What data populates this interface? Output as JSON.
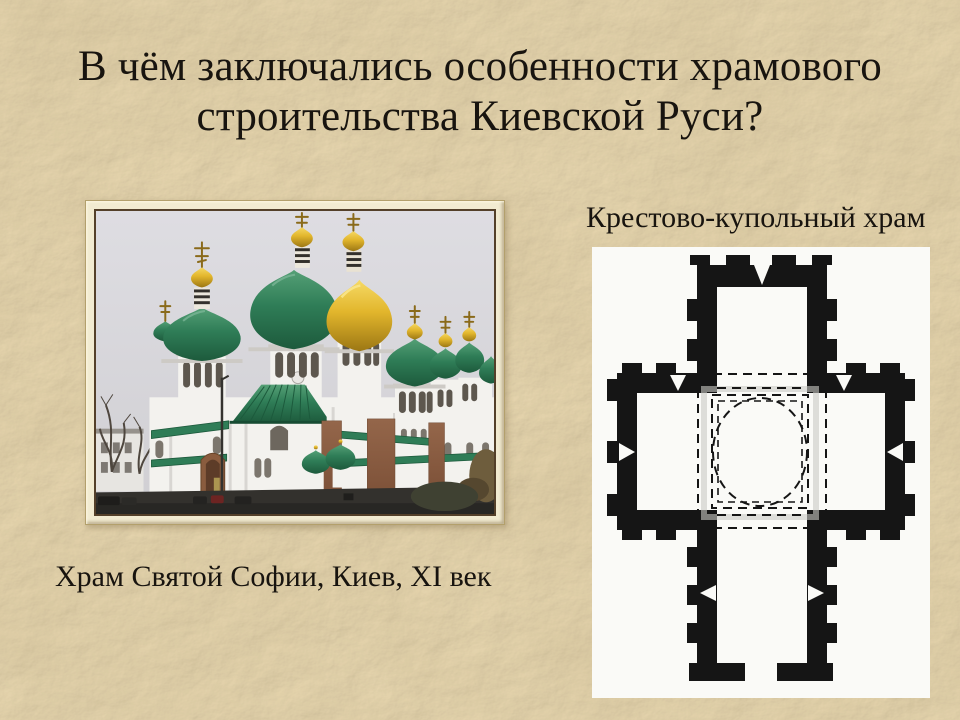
{
  "slide": {
    "title_line1": "В чём заключались особенности храмового",
    "title_line2": "строительства Киевской Руси?"
  },
  "photo": {
    "caption": "Храм Святой Софии, Киев, XI век"
  },
  "plan": {
    "label": "Крестово-купольный храм"
  },
  "colors": {
    "background": "#dbc69e",
    "title_text": "#18140f",
    "frame": "#f2ebd1",
    "frame_line": "#54402a",
    "sky": "#d9d8dc",
    "wall": "#f3f2ee",
    "wall_shade": "#d8d6d2",
    "window_dark": "#5d574e",
    "dome_green": "#2f7d57",
    "dome_green_dark": "#1d5a3c",
    "dome_gold": "#e2b62c",
    "dome_gold_dark": "#9c7714",
    "plan_ink": "#151515",
    "plan_paper": "#fafaf7",
    "brick": "#94664a",
    "ground": "#33312d"
  }
}
